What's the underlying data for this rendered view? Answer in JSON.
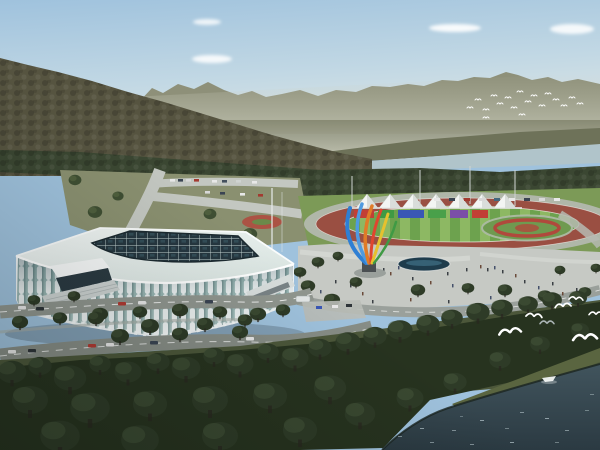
{
  "meta": {
    "title": "Aerial architectural rendering of a riverside sports complex",
    "type": "rendered-photo",
    "elements": "indoor arena, outdoor track stadium with tent canopies, colorful sculpture, plaza with pool and pedestrians, roads with cars and bus, forested hills, river with boat, flying egrets"
  },
  "palette": {
    "sky_top": "#9fc2dd",
    "sky_mid": "#c2d8e4",
    "sky_horizon": "#e3e9e6",
    "cloud": "#ffffff",
    "mountain": "#8e9079",
    "mountain_haze": "#c8cabc",
    "hill_left": "#565440",
    "far_shore": "#6e7259",
    "river_far": "#b0c4ca",
    "tree_band": "#3b4732",
    "tree_fore": "#27331f",
    "ground_grass": "#8a9070",
    "lawn": "#7c9a57",
    "track": "#9a4f42",
    "infield_a": "#8db863",
    "infield_b": "#6da24e",
    "walkway": "#b6bab2",
    "plaza": "#c6c9c4",
    "road": "#90968f",
    "stadium_white": "#edf2f4",
    "stadium_glass": "#9cb9b6",
    "skylight": "#263740",
    "skylight_glass": "#3d5f6a",
    "tent_white": "#f3f5f3",
    "stand_colors": [
      "#c23f35",
      "#3f9a44",
      "#3a57b5",
      "#49a04a",
      "#7b4fa8",
      "#c23f35"
    ],
    "sculpture_blue": "#2f7fd4",
    "sculpture_blue2": "#4f9ae0",
    "sculpture_orange": "#e07b28",
    "sculpture_red": "#e0452f",
    "sculpture_yellow": "#e6c12e",
    "sculpture_green": "#3f9a44",
    "pool": "#1e3c4c",
    "water_top": "#41545d",
    "water_deep": "#2b3a42",
    "shore_grass": "#5a6540",
    "bird": "#ffffff",
    "flower_red": "#b0493c"
  },
  "scene": {
    "sky": {
      "clouds": 4
    },
    "mountains": {
      "left_hill": "forested dark ridge",
      "right_range": "hazy distant mountains"
    },
    "background_flock": {
      "count": 18,
      "location": "in front of right mountains"
    },
    "foreground_birds": {
      "count": 7,
      "location": "over shoreline trees, lower right"
    },
    "arena": {
      "facade": "white vertical ribs with teal glass",
      "roof": "white rim with dark glass grid skylight",
      "entrances": 2
    },
    "track_stadium": {
      "tents": 7,
      "grandstand_blocks": 6,
      "track": "red running oval",
      "infield": "striped green lawn",
      "light_poles": 4
    },
    "garden_roundabout": {
      "shape": "oval with red flower rings"
    },
    "sculpture": {
      "style": "fan of curved colored blades on pedestal"
    },
    "plaza": {
      "reflecting_pool": 1,
      "pedestrians": 27,
      "trees": "scattered"
    },
    "roads": {
      "cars": "multiple white/dark/red cars",
      "bus": 1
    },
    "river": {
      "far_band": "light water behind tree line",
      "foreground": "dark teal water lower right",
      "boat": 1
    }
  }
}
